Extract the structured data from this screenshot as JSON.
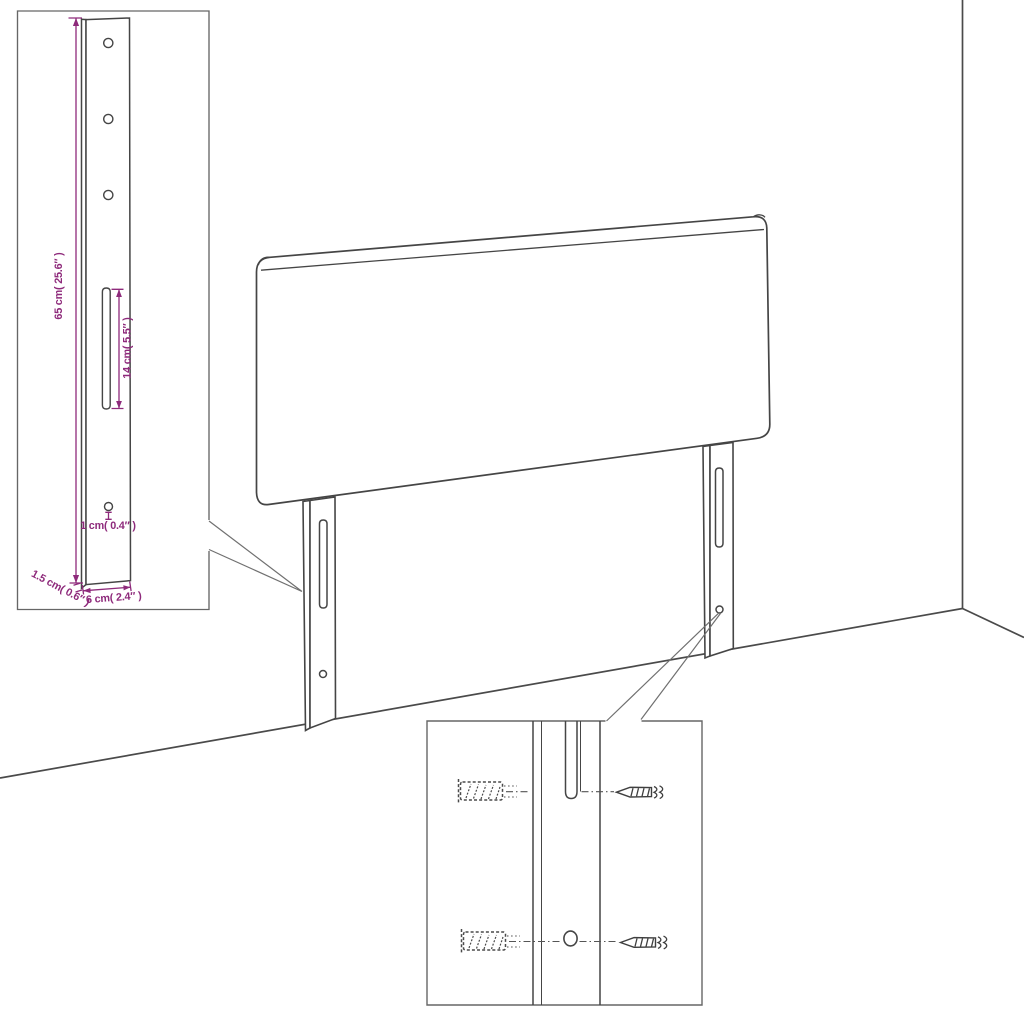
{
  "colors": {
    "background": "#ffffff",
    "drawing_line": "#454545",
    "dimension_accent": "#8e2a7b"
  },
  "icons": {
    "wall_plug": "dashed-anchor-shape",
    "screw": "pointed-screw-shape",
    "mounting_slot": "capsule-slot-shape",
    "screw_hole": "circle-shape"
  },
  "insets": {
    "leg_detail": {
      "dimensions": {
        "leg_height": "65 cm( 25.6″ )",
        "slot_length": "14 cm( 5.5″ )",
        "hole_diameter": "1 cm( 0.4″ )",
        "leg_depth": "1.5 cm( 0.6″ )",
        "leg_width": "6 cm( 2.4″ )"
      }
    }
  }
}
